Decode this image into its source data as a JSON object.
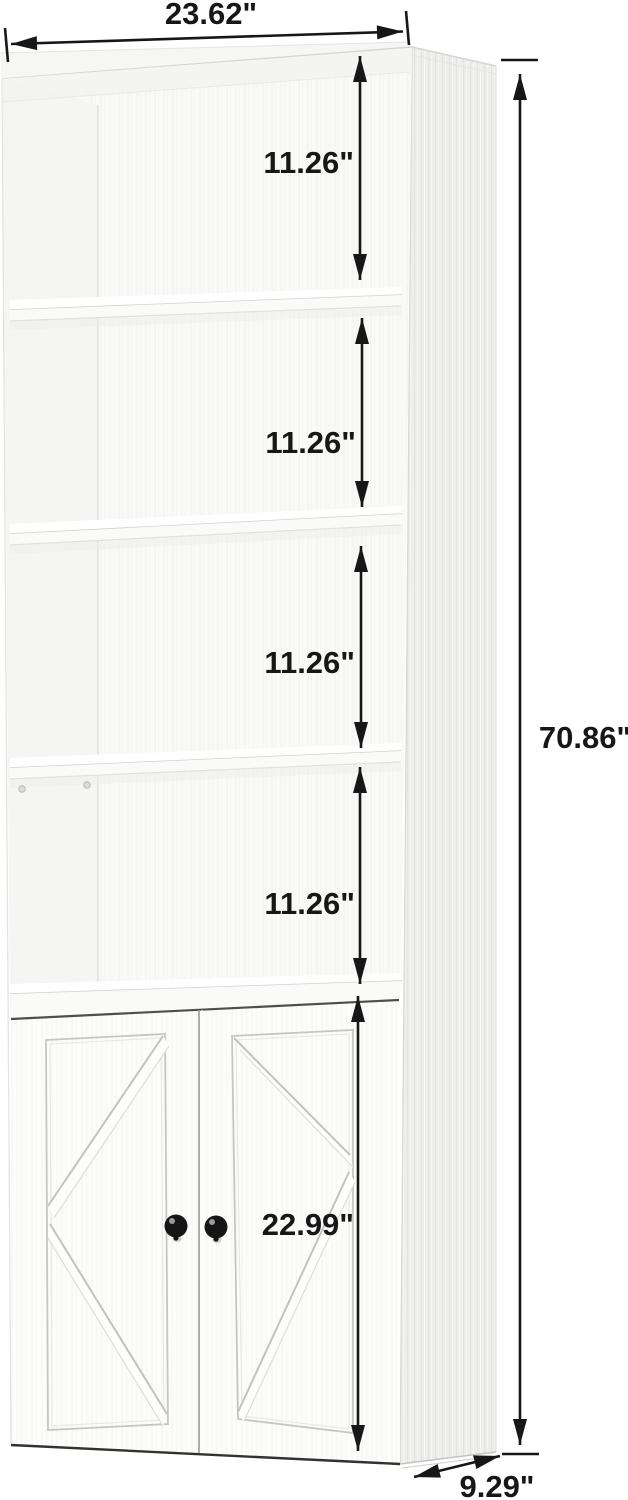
{
  "dimensions": {
    "width": "23.62\"",
    "sections": [
      "11.26\"",
      "11.26\"",
      "11.26\"",
      "11.26\""
    ],
    "total_height": "70.86\"",
    "door_section_height": "22.99\"",
    "depth": "9.29\""
  },
  "colors": {
    "ink": "#171717",
    "background": "#ffffff",
    "wood_white": "#fcfcfb",
    "side_panel": "#ededec",
    "groove": "#c6c6c4",
    "knob": "#161616"
  }
}
